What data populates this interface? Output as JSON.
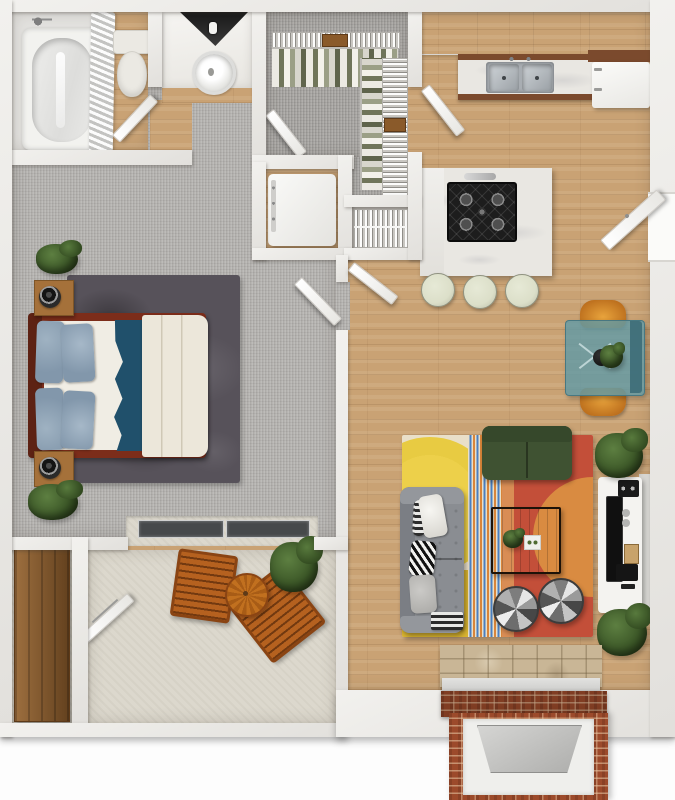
{
  "meta": {
    "type": "3d-floor-plan-top-view",
    "description": "Top-down 3D rendering of a one-bedroom apartment floor plan"
  },
  "palette": {
    "bg": "#fdfdfd",
    "wall": "#f2f1ee",
    "wallShade": "#e2e0dc",
    "wood": "#c9a274",
    "carpet": "#b7b5b2",
    "closetCarpet": "#a9a7a4",
    "concrete": "#dcd8cd",
    "lino": "#e3e2df",
    "shagRug": "#57525a",
    "bedFrame": "#7c2d1a",
    "mattress": "#f0ede4",
    "pillowBlue": "#8297ab",
    "blanketTeal": "#20506b",
    "duvet": "#ece7da",
    "nightstandWood": "#a5713a",
    "marble": "#e9e7e2",
    "cabinetBrown": "#7b4a2d",
    "steel": "#b9bec2",
    "cooktopBlack": "#1d1d1d",
    "stoolCream": "#dcdfc9",
    "fridgeWhite": "#f6f6f4",
    "rugCream": "#e9dfc9",
    "rugYellow": "#e8cb42",
    "rugMustard": "#d9b430",
    "rugBlue": "#4a7fc1",
    "rugOrange": "#d9853a",
    "rugRed": "#c34f39",
    "rugDisc": "#d98b41",
    "sofaGray": "#8a8d92",
    "loveseatGreen": "#3f5232",
    "coffeeTableWood": "#5f3014",
    "shelfTan": "#c9a071",
    "consoleWhite": "#f4f3f0",
    "tvBlack": "#101010",
    "teal": "#619aa5",
    "chairOrange": "#d08a33",
    "patioWood": "#b5611f",
    "storageWood": "#8a5a2a",
    "plantGreen": "#3f5b2e",
    "brick": "#9c4a2b",
    "tile": "#c9b696",
    "mantel": "#d3d3d1",
    "glassDark": "#46494b"
  },
  "rooms": {
    "bathroom": {
      "label": "Bathroom",
      "items": [
        "bathtub",
        "shower curtain",
        "shower head",
        "toilet"
      ]
    },
    "vanity": {
      "label": "Vanity nook",
      "items": [
        "corner shelf",
        "vessel sink"
      ]
    },
    "closet": {
      "label": "Walk-in closet",
      "items": [
        "wire shelf",
        "hanging clothes",
        "side rack",
        "storage boxes"
      ]
    },
    "laundry": {
      "label": "Laundry closet",
      "items": [
        "washer-dryer"
      ]
    },
    "pantry": {
      "label": "Pantry",
      "items": [
        "wire shelving"
      ]
    },
    "kitchen": {
      "label": "Kitchen",
      "items": [
        "upper cabinets",
        "countertop",
        "double sink",
        "refrigerator",
        "island",
        "gas cooktop",
        "3 bar stools"
      ]
    },
    "entry": {
      "label": "Entry",
      "items": [
        "front door"
      ]
    },
    "dining": {
      "label": "Dining nook",
      "items": [
        "glass table",
        "2 orange chairs",
        "centerpiece plant"
      ]
    },
    "living": {
      "label": "Living room",
      "items": [
        "area rug",
        "gray sofa",
        "green loveseat",
        "coffee table",
        "2 ottomans",
        "media console",
        "tv",
        "plants"
      ]
    },
    "bedroom": {
      "label": "Bedroom",
      "items": [
        "bed",
        "4 pillows",
        "duvet",
        "teal blanket",
        "shag rug",
        "2 nightstands",
        "sliding glass door",
        "plants"
      ]
    },
    "patio": {
      "label": "Patio",
      "items": [
        "2 slat chairs",
        "bistro table",
        "plant",
        "storage closet",
        "wood cabinet"
      ]
    },
    "fireplace": {
      "label": "Fireplace",
      "items": [
        "brick hearth",
        "marble mantel",
        "tile surround"
      ]
    }
  }
}
